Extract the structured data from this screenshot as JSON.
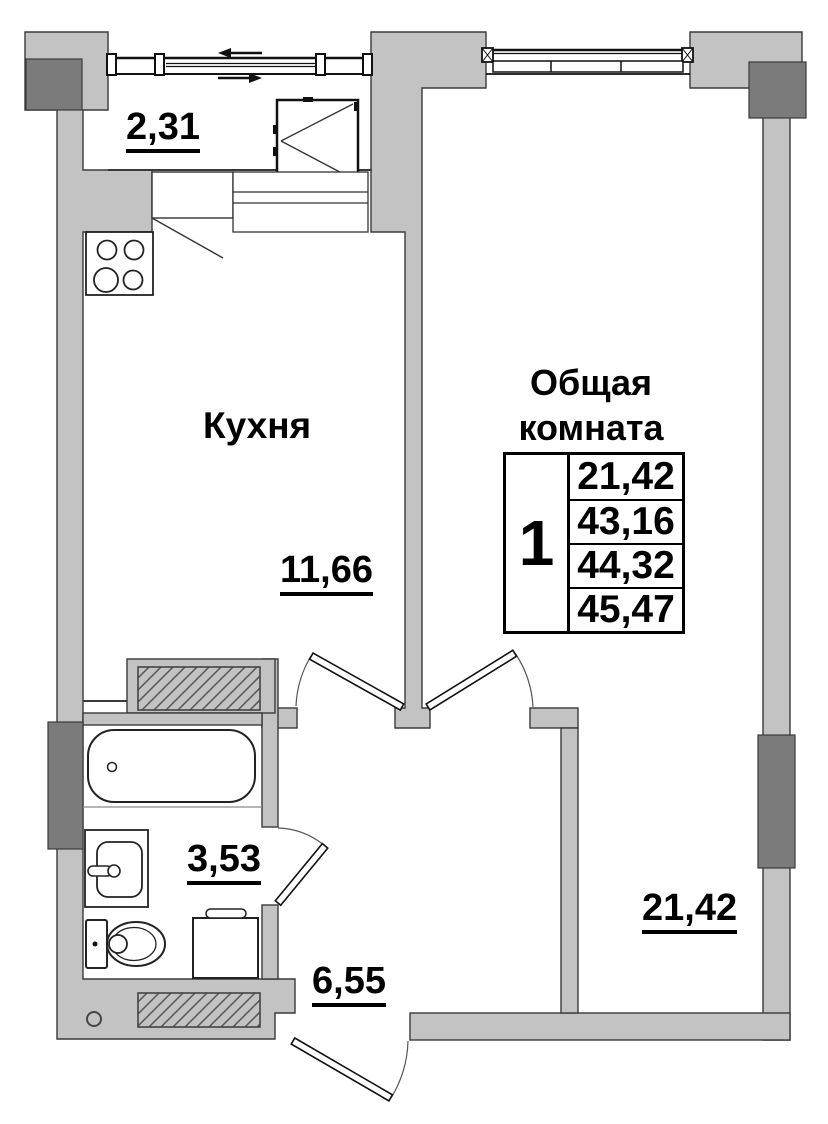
{
  "plan": {
    "balcony": {
      "area": "2,31"
    },
    "kitchen": {
      "name": "Кухня",
      "area": "11,66"
    },
    "bathroom": {
      "area": "3,53"
    },
    "hall": {
      "area": "6,55"
    },
    "living_room": {
      "name_line1": "Общая",
      "name_line2": "комната",
      "area": "21,42"
    },
    "legend_table": {
      "rooms_count": "1",
      "values": [
        "21,42",
        "43,16",
        "44,32",
        "45,47"
      ]
    },
    "colors": {
      "wall_fill": "#c3c3c3",
      "pilaster_fill": "#7b7b7b",
      "outline": "#3a3a3a"
    }
  }
}
